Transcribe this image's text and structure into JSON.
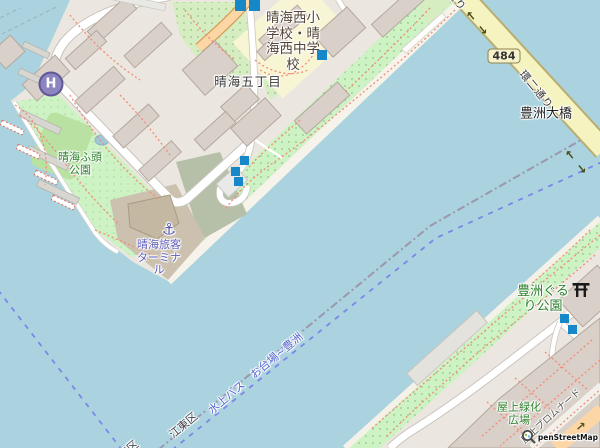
{
  "labels": {
    "school": {
      "l1": "晴海西小",
      "l2": "学校・晴",
      "l3": "海西中学",
      "l4": "校"
    },
    "district": "晴海五丁目",
    "harumi_park": {
      "l1": "晴海ふ頭",
      "l2": "公園"
    },
    "terminal": {
      "l1": "晴海旅客",
      "l2": "ターミナ",
      "l3": "ル"
    },
    "heliport": "H",
    "anchor_icon": "⚓",
    "route_badge": "484",
    "ring_road": "環二通り",
    "bridge": "豊洲大橋",
    "toyosu_park": {
      "l1": "豊洲ぐる",
      "l2": "り公園"
    },
    "rooftop_plaza": {
      "l1": "屋上緑化",
      "l2": "広場"
    },
    "rooftop_promenade": "屋上プロムナード",
    "ward_boundary": "江東区",
    "ward_boundary_partial": "江東区",
    "water_bus_route": "水上バス　お台場~豊洲",
    "attribution": "penStreetMap"
  },
  "oneway_arrows": {
    "back": "←",
    "fwd": "→"
  },
  "colors": {
    "water": "#aad3df",
    "land": "#ebe7e0",
    "park_green": "#cdf3c4",
    "grass_dotted": "#d6edc1",
    "field_green": "#b9e2a2",
    "building": "#d9d0c9",
    "building_border": "#b3a89e",
    "road_primary": "#fcd6a4",
    "road_secondary": "#f5f3c0",
    "road_white": "#ffffff",
    "beach": "#f6f3ea",
    "marker_blue": "#1688c9",
    "label_park_green": "#2c7f2c",
    "label_terminal": "#5d5dbb",
    "ferry_blue": "#7c86e8",
    "ferry_label": "#4f63cf",
    "boundary_gray": "#9b8faa",
    "footpath_red": "#f48a75",
    "terminal_ground": "#ccc1ae",
    "apron_green_gray": "#b6c0a8"
  }
}
